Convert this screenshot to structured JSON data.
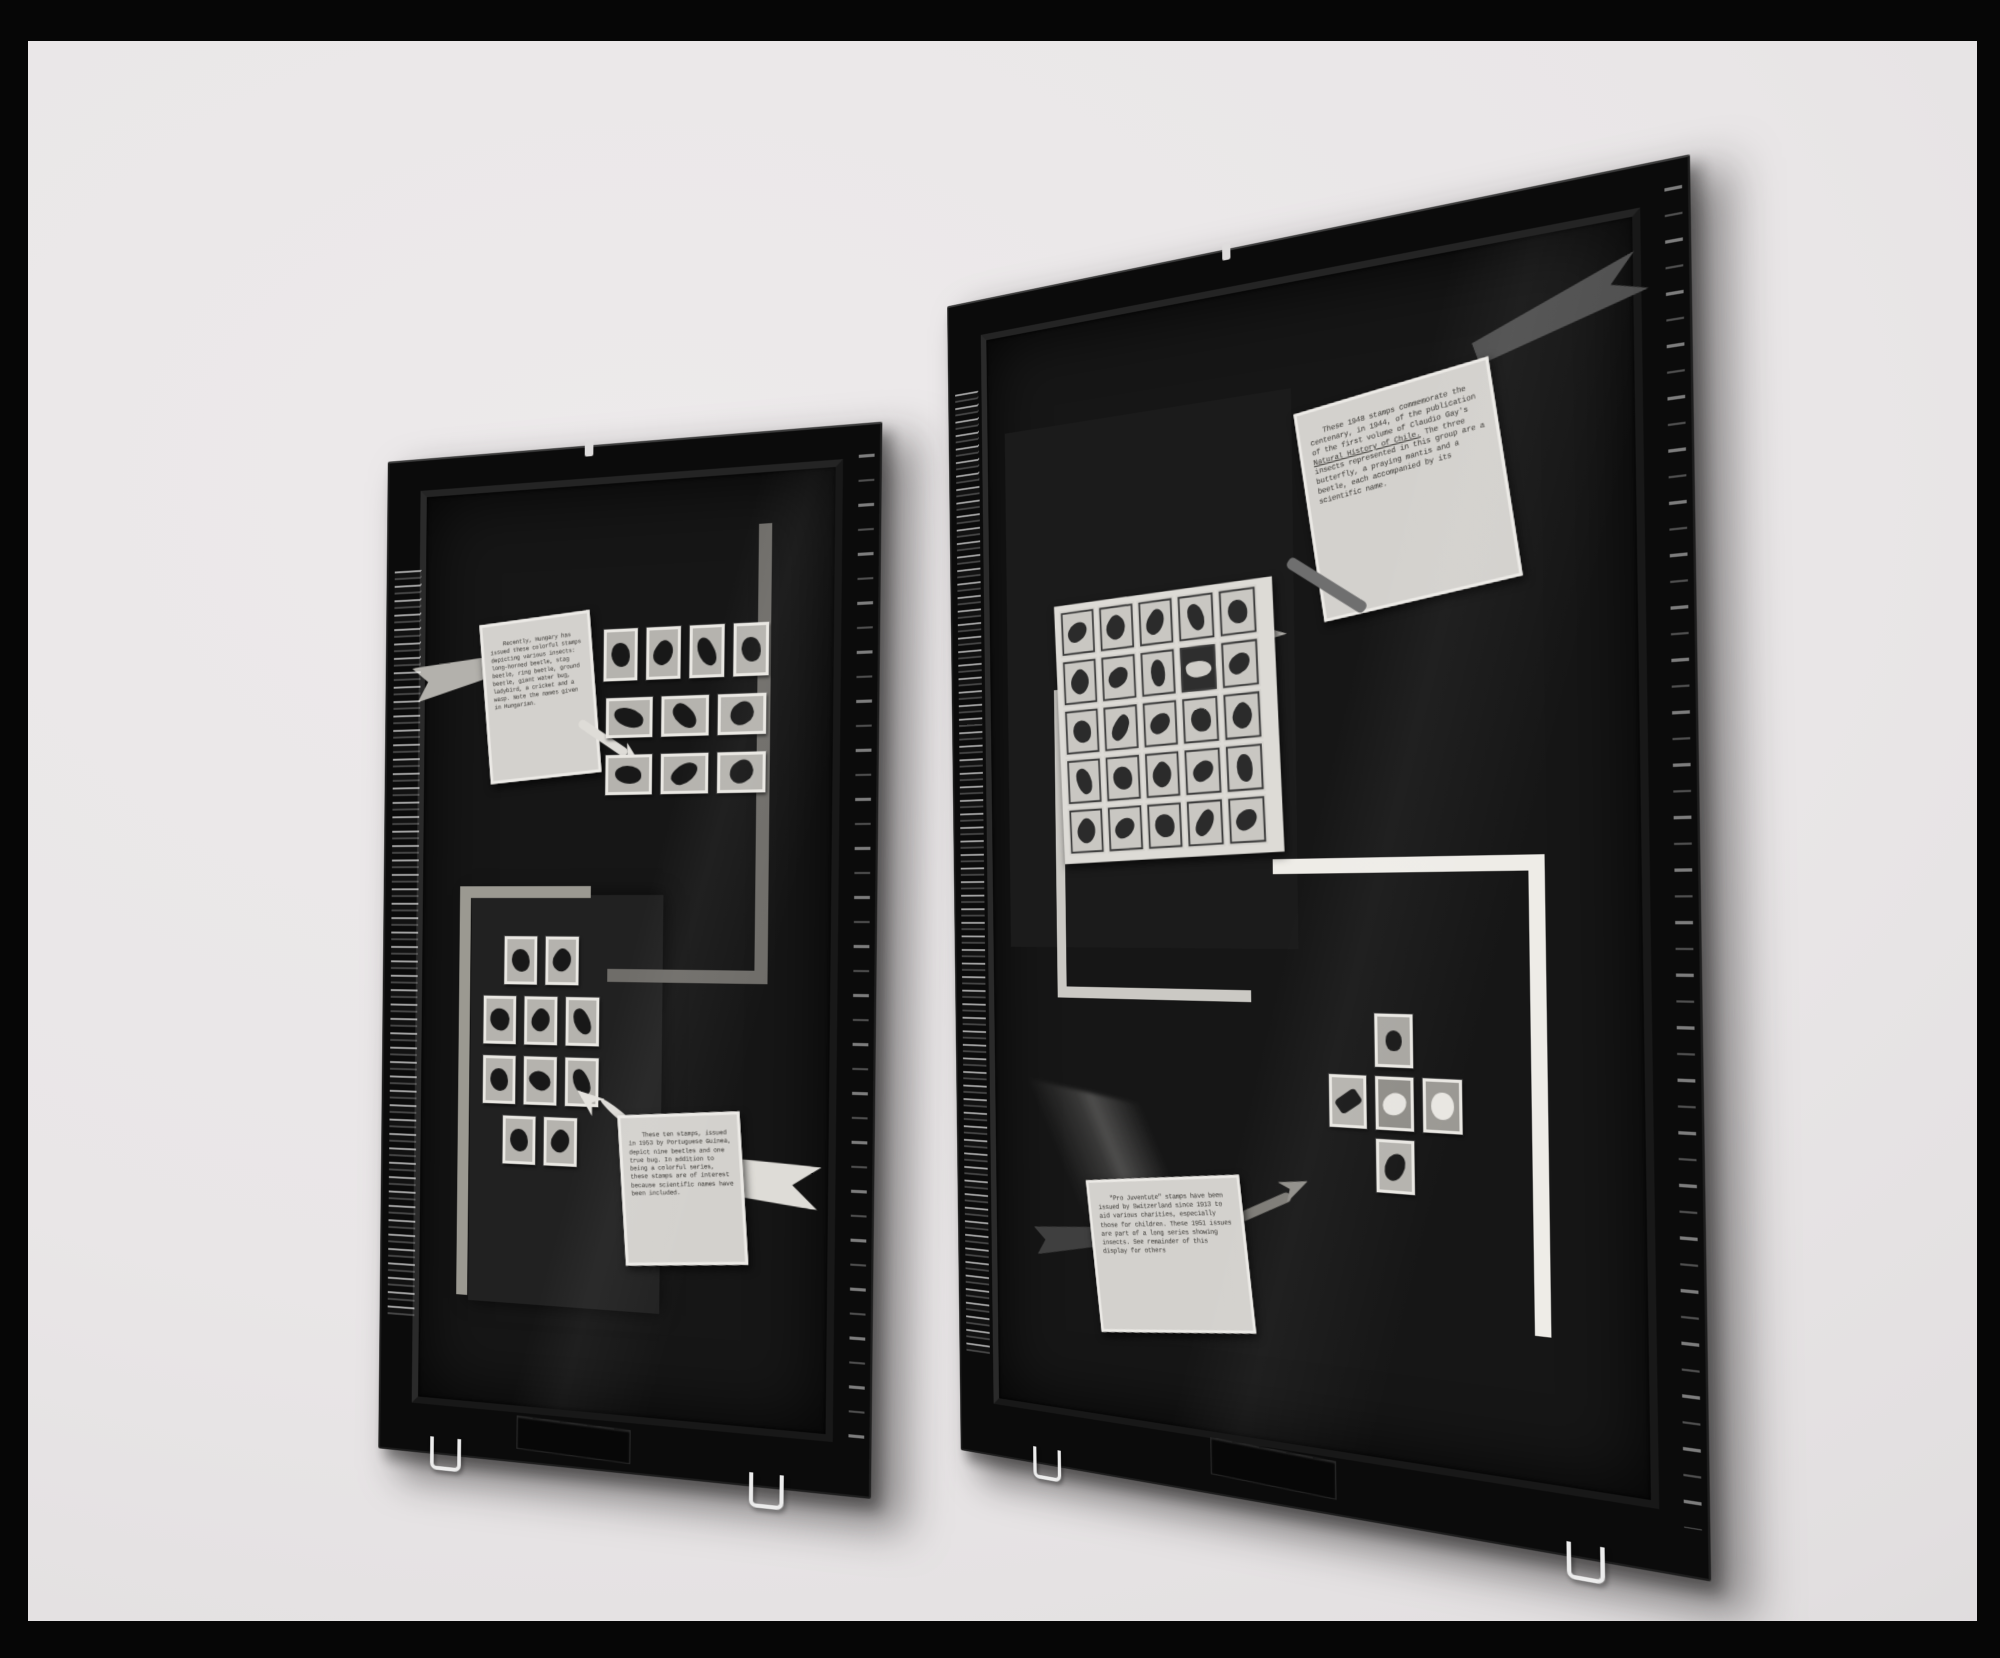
{
  "photo": {
    "description": "Black-and-white photograph of two glass-fronted exhibit panels of insect postage stamps hanging on a light wall",
    "paper_color": "#e9e6e7",
    "scan_border_color": "#060606",
    "frame_color": "#0b0b0b",
    "mat_color": "#161616"
  },
  "colors": {
    "card_paper": "#d3d1cd",
    "arrow_light": "#dedcd7",
    "ribbon_light": "#b3b1ac",
    "ribbon_dark": "#4f4f4f",
    "accent_line_white": "#eeece7",
    "accent_line_gray": "#6f6d69"
  },
  "boards": {
    "left": {
      "name": "insect stamp display panel 1",
      "labels": [
        {
          "id": "hungary",
          "text": "Recently, Hungary has issued these colorful stamps depicting various insects: long-horned beetle, stag beetle, ring beetle, ground beetle, giant water bug, ladybird, a cricket and a wasp. Note the names given in Hungarian."
        },
        {
          "id": "portuguese-guinea",
          "text": "These ten stamps, issued in 1953 by Portuguese Guinea, depict nine beetles and one true bug. In addition to being a colorful series, these stamps are of interest because scientific names have been included."
        }
      ],
      "stamp_groups": [
        {
          "motif": "insects on Hungarian stamps",
          "count": 10,
          "rows": [
            4,
            3,
            3
          ]
        },
        {
          "motif": "beetles on Portuguese Guinea stamps",
          "count": 10,
          "rows": [
            2,
            3,
            3,
            2
          ]
        }
      ]
    },
    "right": {
      "name": "insect stamp display panel 2",
      "labels": [
        {
          "id": "chile",
          "text_before": "These 1948 stamps commemorate the centenary, in 1944, of the publication of the first volume of Claudio Gay's ",
          "text_underlined": "Natural History of Chile.",
          "text_after": "  The three insects represented in this group are a butterfly, a praying mantis and a beetle, each accompanied by its scientific name."
        },
        {
          "id": "pro-juventute",
          "text": "\"Pro Juventute\" stamps have been issued by Switzerland since 1913 to aid various charities, especially those for children. These 1951 issues are part of a long series showing insects.  See remainder of this display for others"
        }
      ],
      "sheet": {
        "rows": 5,
        "cols": 5,
        "motif": "sheet of 25 Chilean stamps depicting animals",
        "motifs": [
          "monkey",
          "tree",
          "birds",
          "pelican",
          "elephant",
          "crab",
          "flowers",
          "penguins",
          "bat",
          "songbird",
          "spider",
          "fish",
          "lizard",
          "seashell",
          "eagle",
          "fruit",
          "heron",
          "deer",
          "crocodile",
          "bison",
          "fish",
          "seabird",
          "palm trees",
          "swan",
          "eel"
        ]
      },
      "cross_group": {
        "motif": "five Swiss Pro Juventute 1951 stamps arranged in a cross",
        "motifs": [
          "portrait of a woman",
          "dragonfly",
          "butterfly",
          "moth",
          "beetle"
        ]
      }
    }
  }
}
